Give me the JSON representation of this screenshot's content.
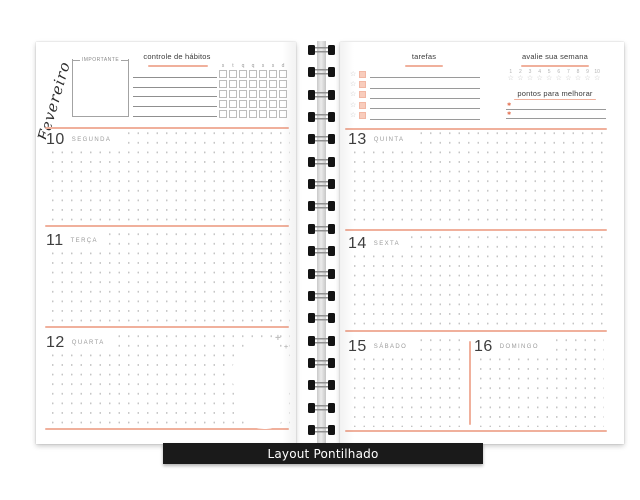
{
  "product_label": "Layout Pontilhado",
  "colors": {
    "accent": "#f0b09c",
    "accent_fill": "#f8ccbc",
    "label_bar_bg": "#1a1a1a",
    "label_bar_text": "#ffffff"
  },
  "left_page": {
    "month": "Fevereiro",
    "important_box_label": "IMPORTANTE",
    "habit_tracker": {
      "title": "controle de hábitos",
      "day_initials": [
        "s",
        "t",
        "q",
        "q",
        "s",
        "s",
        "d"
      ],
      "rows": 5,
      "note_lines": 5
    },
    "days": [
      {
        "number": "10",
        "name": "SEGUNDA"
      },
      {
        "number": "11",
        "name": "TERÇA"
      },
      {
        "number": "12",
        "name": "QUARTA"
      }
    ],
    "sparkles": [
      "+",
      "+"
    ]
  },
  "right_page": {
    "tasks": {
      "title": "tarefas",
      "row_count": 5
    },
    "week_rating": {
      "title": "avalie sua semana",
      "scale": [
        "1",
        "2",
        "3",
        "4",
        "5",
        "6",
        "7",
        "8",
        "9",
        "10"
      ]
    },
    "improvements": {
      "title": "pontos para melhorar",
      "line_count": 2
    },
    "days": [
      {
        "number": "13",
        "name": "QUINTA"
      },
      {
        "number": "14",
        "name": "SEXTA"
      }
    ],
    "weekend_days": [
      {
        "number": "15",
        "name": "SÁBADO"
      },
      {
        "number": "16",
        "name": "DOMINGO"
      }
    ]
  },
  "binding": {
    "ring_count": 18
  }
}
